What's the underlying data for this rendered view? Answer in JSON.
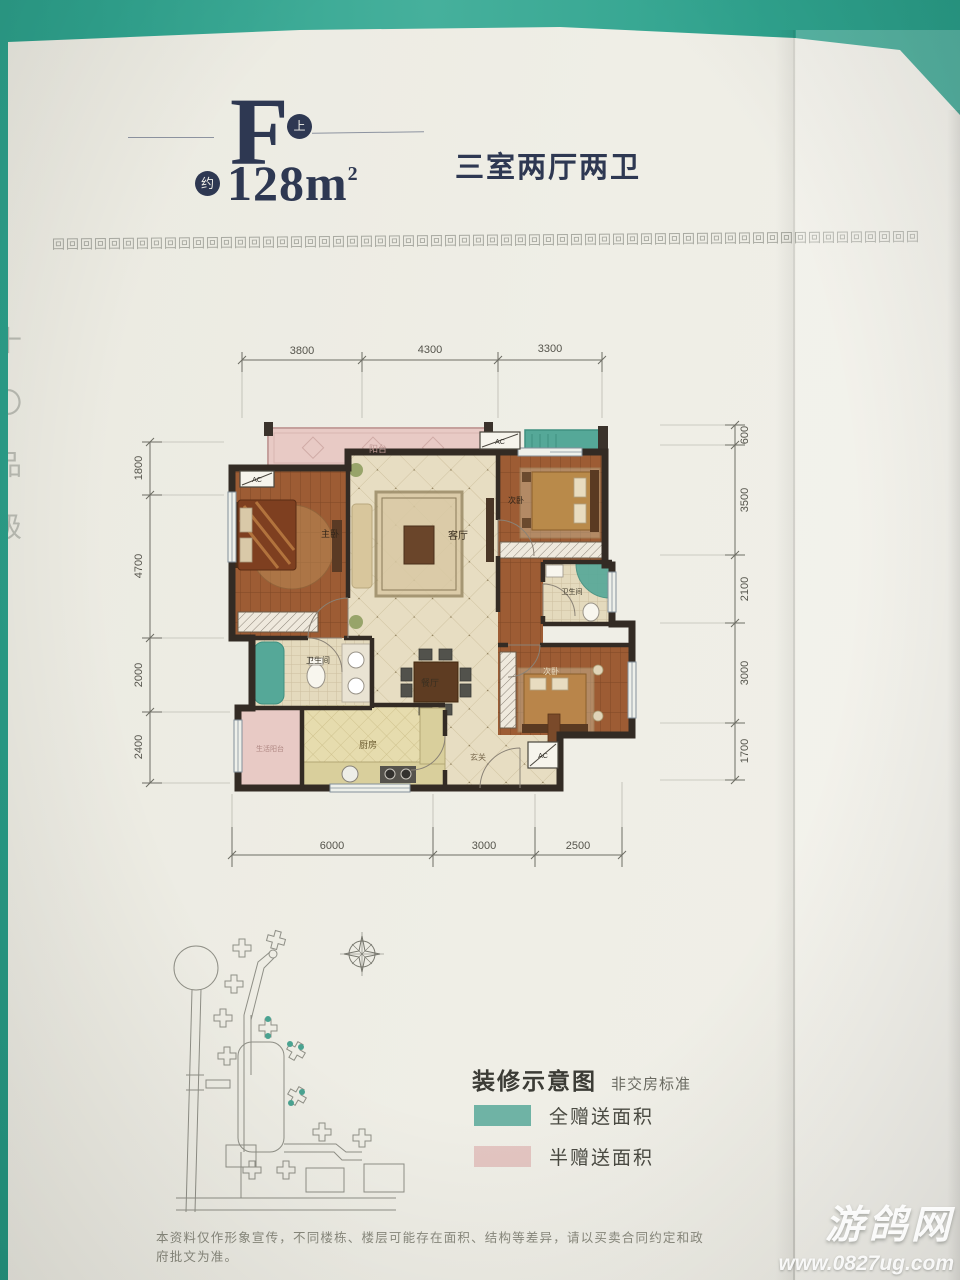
{
  "header": {
    "unit_letter": "F",
    "unit_badge": "上",
    "approx_label": "约",
    "area_number": "128",
    "area_unit": "m",
    "area_exponent": "2",
    "subtitle": "三室两厅两卫"
  },
  "decor": {
    "border_glyph": "回",
    "border_repeat": 62,
    "edge_text": "十〇品级"
  },
  "plan": {
    "dims": {
      "top": [
        "3800",
        "4300",
        "3300"
      ],
      "bottom": [
        "6000",
        "3000",
        "2500"
      ],
      "left": [
        "1800",
        "4700",
        "2000",
        "2400"
      ],
      "right": [
        "600",
        "3500",
        "2100",
        "3000",
        "1700"
      ]
    },
    "rooms": {
      "balcony": "阳台",
      "master": "主卧",
      "living": "客厅",
      "bedroom2": "次卧",
      "bath2": "卫生间",
      "dining": "餐厅",
      "bath1": "卫生间",
      "kitchen": "厨房",
      "service_balcony": "生活阳台",
      "entry": "玄关",
      "bedroom3": "次卧",
      "ac": "AC"
    },
    "colors": {
      "full_gift": "#55a898",
      "half_gift": "#e8cac5"
    }
  },
  "legend": {
    "title": "装修示意图",
    "note": "非交房标准",
    "items": [
      {
        "label": "全赠送面积",
        "color": "#6fb3a5"
      },
      {
        "label": "半赠送面积",
        "color": "#e3c5c1"
      }
    ]
  },
  "disclaimer": "本资料仅作形象宣传，不同楼栋、楼层可能存在面积、结构等差异，请以买卖合同约定和政府批文为准。",
  "watermark": {
    "site_name": "游鸽网",
    "site_url": "www.0827ug.com"
  }
}
